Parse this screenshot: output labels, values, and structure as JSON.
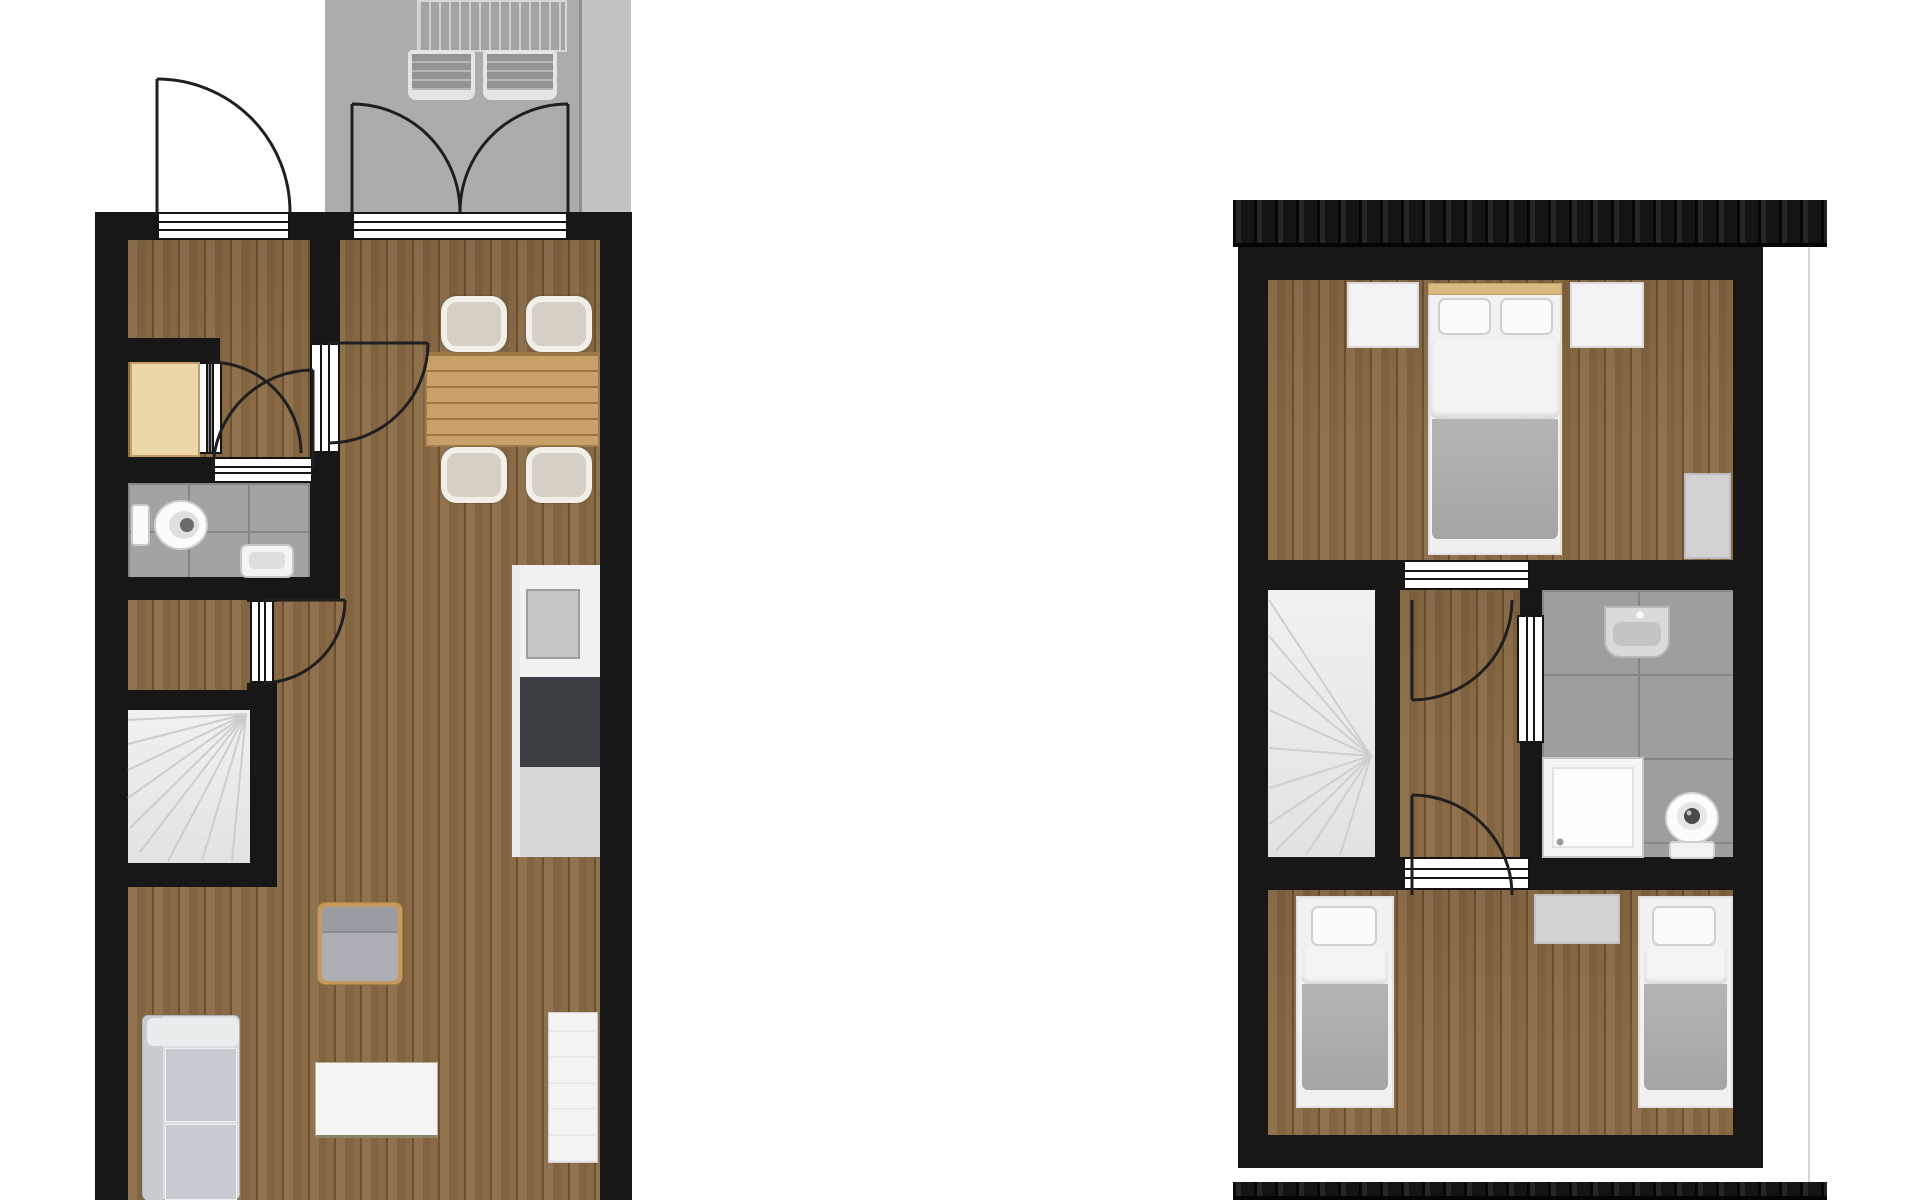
{
  "scene": {
    "kind": "architectural-floor-plan",
    "description": "Top-down two-panel floor plan with no text labels: ground floor on the left with terrace, upper (attic) floor on the right with roof eaves.",
    "floors": [
      {
        "id": "ground-floor",
        "panel": "left",
        "outdoor": {
          "name": "terrace",
          "furniture": [
            "sun-lounger",
            "sun-lounger"
          ]
        },
        "rooms": [
          {
            "name": "entry-hall",
            "furniture": []
          },
          {
            "name": "wardrobe-nook",
            "furniture": [
              "tan-wardrobe"
            ]
          },
          {
            "name": "wc",
            "furniture": [
              "toilet",
              "hand-basin"
            ]
          },
          {
            "name": "staircase",
            "furniture": [
              "winder-stairs"
            ]
          },
          {
            "name": "living-dining-kitchen",
            "furniture": [
              "dining-table",
              "dining-chair",
              "dining-chair",
              "dining-chair",
              "dining-chair",
              "kitchen-counter",
              "kitchen-sink",
              "cooktop",
              "base-cabinet",
              "armchair",
              "coffee-table",
              "sofa",
              "sideboard"
            ]
          }
        ],
        "doors": [
          "front-entry-door",
          "terrace-double-door",
          "wardrobe-nook-door",
          "wc-door",
          "hall-to-living-door",
          "stair-hall-door"
        ]
      },
      {
        "id": "upper-floor",
        "panel": "right",
        "roof": {
          "eaves": [
            "top",
            "bottom"
          ],
          "gable-outline": "right side"
        },
        "rooms": [
          {
            "name": "bedroom-1",
            "furniture": [
              "double-bed",
              "nightstand",
              "nightstand",
              "wardrobe"
            ]
          },
          {
            "name": "landing",
            "furniture": []
          },
          {
            "name": "staircase",
            "furniture": [
              "winder-stairs"
            ]
          },
          {
            "name": "bathroom",
            "furniture": [
              "washbasin",
              "shower",
              "toilet"
            ]
          },
          {
            "name": "bedroom-2",
            "furniture": [
              "single-bed",
              "single-bed",
              "rug"
            ]
          }
        ],
        "doors": [
          "bedroom-1-door",
          "bedroom-2-door",
          "bathroom-door"
        ]
      }
    ]
  },
  "colors": {
    "wall": "#171717",
    "floor": "#8a6a44",
    "terrace": "#acacac",
    "terrace_right": "#c2c2c2",
    "tile_small": "#a3a3a3",
    "tile_large": "#9e9e9e",
    "grout": "#868686",
    "stairs": "#ececec",
    "stair_tread": "#cccccc",
    "threshold": "#ffffff",
    "door_line": "#1f1f1f",
    "wardrobe_tan": "#ecd7a9",
    "wardrobe_tan_border": "#c2a066",
    "table_wood": "#c7a169",
    "counter": "#f1f1f1",
    "sink": "#c6c6c6",
    "stove": "#3c3f43",
    "cabinet": "#d8d8d8",
    "chair_rim": "#f2efe9",
    "chair_seat": "#d5cfc5",
    "sofa": "#dadfe2",
    "sofa_cushion": "#c5cbd0",
    "white_furn": "#f3f3f3",
    "blanket": "#ababab",
    "headboard": "#d9ba80",
    "gray_furn": "#d2d2d2",
    "roof": "#161616",
    "fixture": "#fbfbfb",
    "fixture_line": "#c9c9c9"
  }
}
